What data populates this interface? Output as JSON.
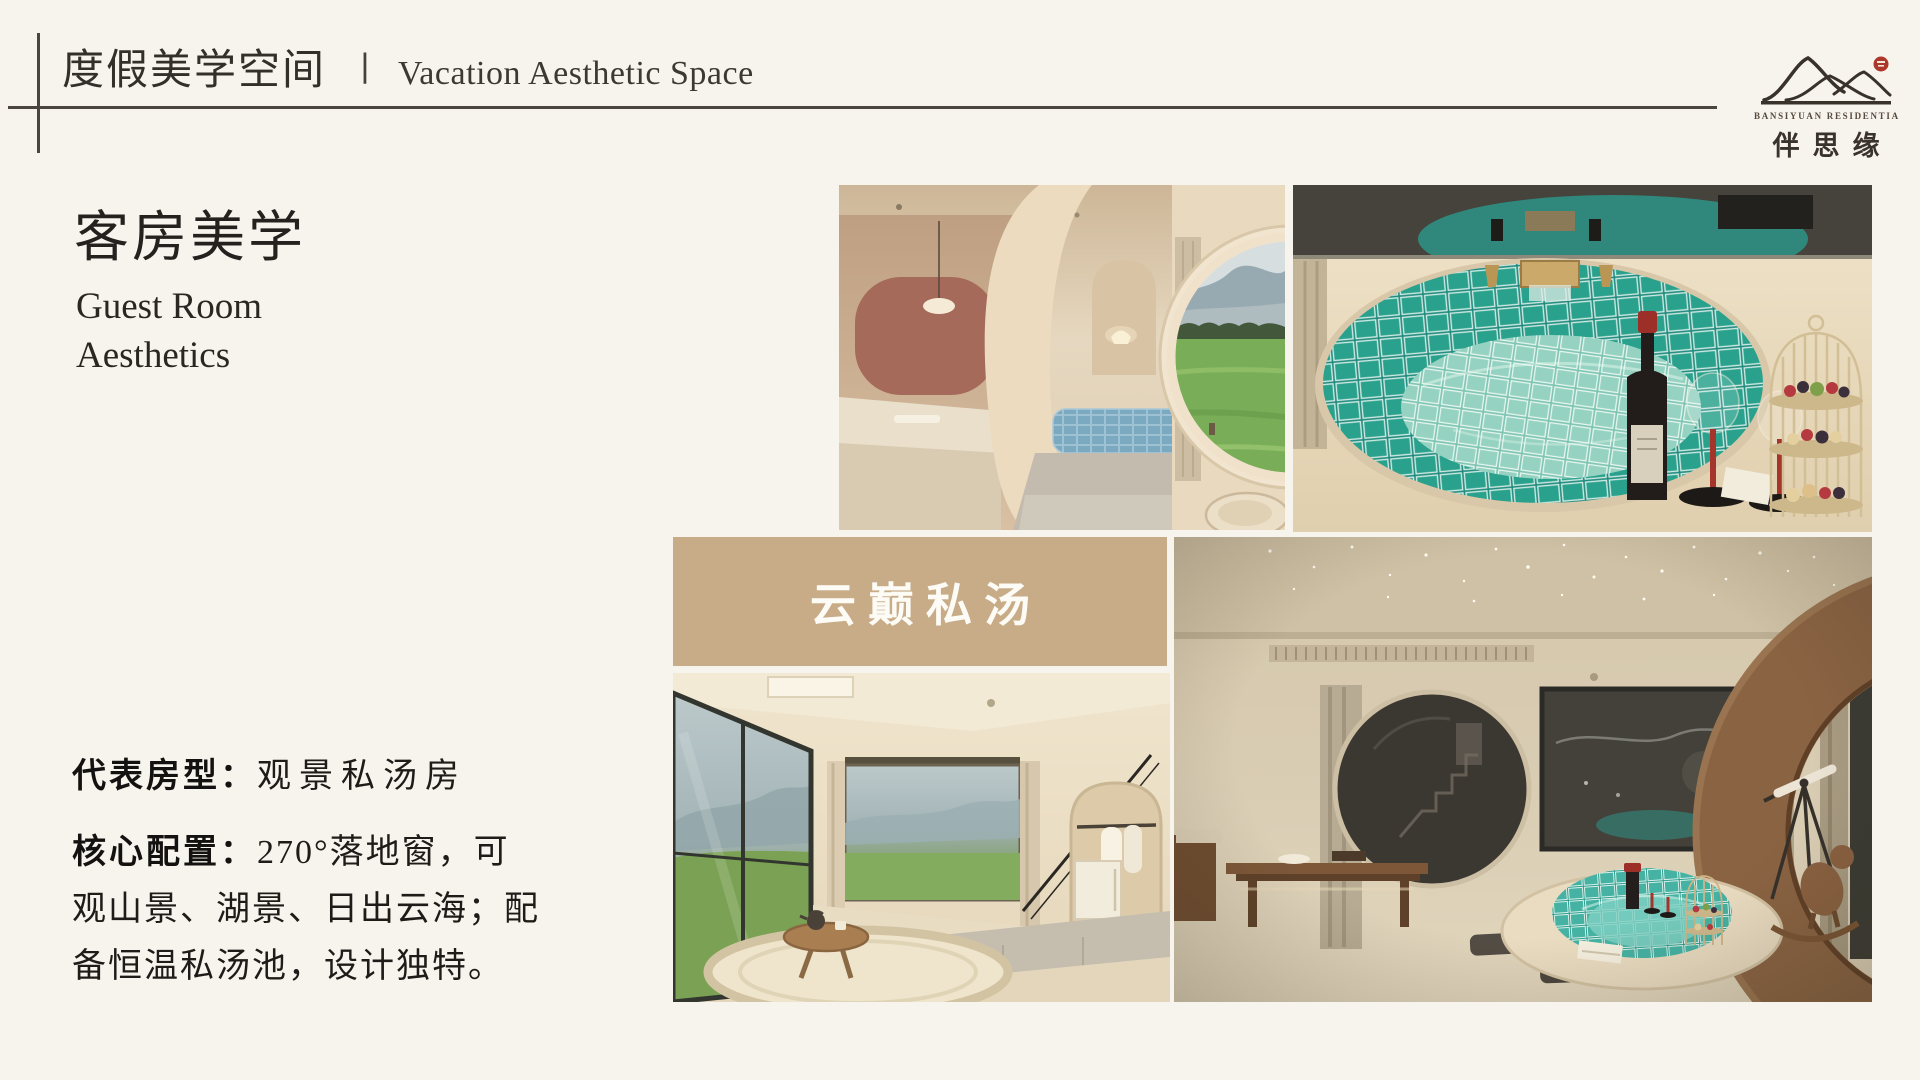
{
  "header": {
    "title_zh": "度假美学空间",
    "separator": "丨",
    "title_en": "Vacation Aesthetic Space"
  },
  "logo": {
    "name_en": "BANSIYUAN RESIDENTIA",
    "name_zh": "伴思缘",
    "seal_color": "#ae372b"
  },
  "section": {
    "heading_zh": "客房美学",
    "heading_en_line1": "Guest Room",
    "heading_en_line2": "Aesthetics"
  },
  "details": {
    "room_type_label": "代表房型：",
    "room_type_value": "观景私汤房",
    "config_label": "核心配置：",
    "config_line1": "270°落地窗，可",
    "config_line2": "观山景、湖景、日出云海；配",
    "config_line3": "备恒温私汤池，设计独特。"
  },
  "gallery": {
    "badge_label": "云巅私汤",
    "badge_bg": "#c8ac88"
  },
  "colors": {
    "background": "#f7f4ee",
    "rule": "#4a4540",
    "ink": "#332f2b",
    "teal_pool": "#2a9184"
  }
}
